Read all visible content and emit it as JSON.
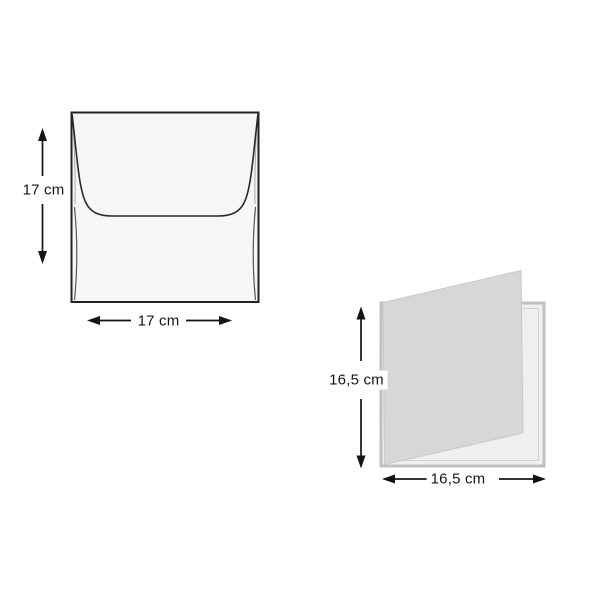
{
  "figures": {
    "envelope": {
      "name": "square envelope, back view with closed flap",
      "height_label": "17 cm",
      "width_label": "17 cm"
    },
    "card": {
      "name": "square folded card, slightly open",
      "height_label": "16,5 cm",
      "width_label": "16,5 cm"
    }
  },
  "colors": {
    "background": "#ffffff",
    "dimension_ink": "#141414",
    "envelope_fill": "#f6f6f6",
    "envelope_outline": "#222222",
    "card_cover_fill": "#d7d7d7",
    "card_panel_fill": "#efefef",
    "card_panel_border": "#c0c0c0"
  }
}
